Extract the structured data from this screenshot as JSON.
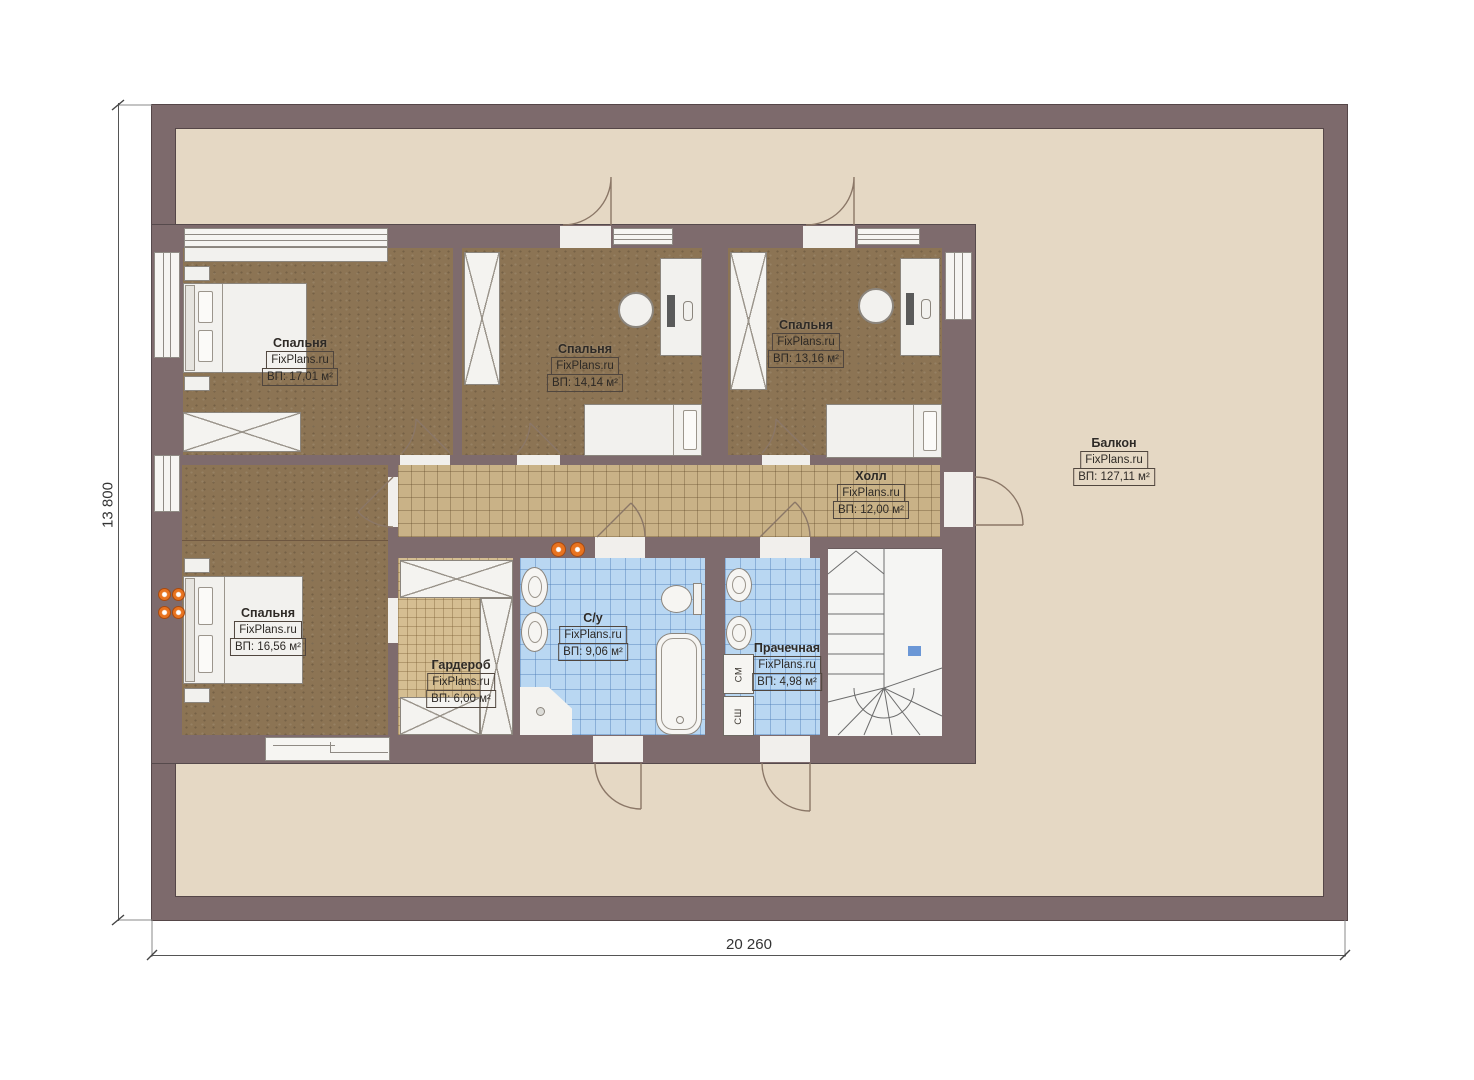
{
  "watermark": "FixPlans.ru",
  "dimensions": {
    "vertical": "13 800",
    "horizontal": "20 260"
  },
  "rooms": [
    {
      "id": "bedroom-1",
      "name": "Спальня",
      "area": "ВП: 17,01 м²"
    },
    {
      "id": "bedroom-2",
      "name": "Спальня",
      "area": "ВП: 14,14 м²"
    },
    {
      "id": "bedroom-3",
      "name": "Спальня",
      "area": "ВП: 13,16 м²"
    },
    {
      "id": "bedroom-4",
      "name": "Спальня",
      "area": "ВП: 16,56 м²"
    },
    {
      "id": "hall",
      "name": "Холл",
      "area": "ВП: 12,00 м²"
    },
    {
      "id": "wardrobe",
      "name": "Гардероб",
      "area": "ВП: 6,00 м²"
    },
    {
      "id": "bathroom",
      "name": "С/у",
      "area": "ВП: 9,06 м²"
    },
    {
      "id": "laundry",
      "name": "Прачечная",
      "area": "ВП: 4,98 м²"
    },
    {
      "id": "balcony",
      "name": "Балкон",
      "area": "ВП: 127,11 м²"
    }
  ],
  "appliances": {
    "washer": "СМ",
    "dryer": "СШ"
  },
  "colors": {
    "wall": "#7e6b6d",
    "balcony_floor": "#e5d8c4",
    "bedroom_floor": "#8c7454",
    "hall_tile": "#c9b287",
    "carpet": "#d5be92",
    "wet_tile": "#b9d7f2",
    "radiator_orange": "#e8731f",
    "stair_marker_blue": "#6b97d6"
  }
}
